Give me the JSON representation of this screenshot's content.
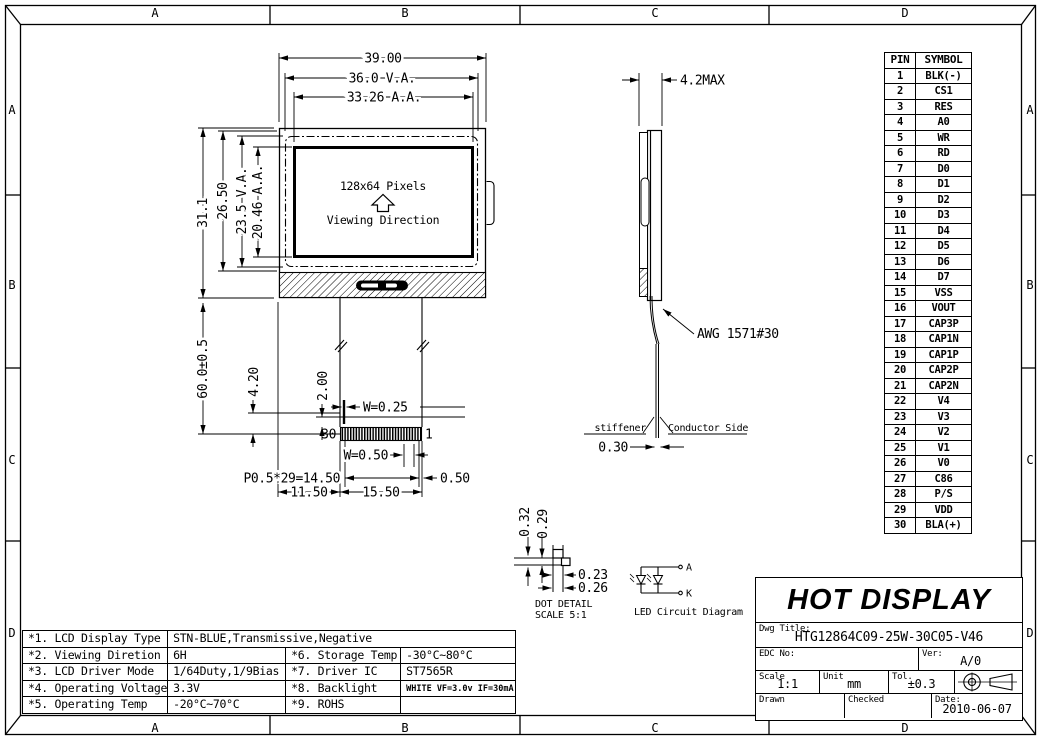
{
  "sheet": {
    "zone_columns": [
      "A",
      "B",
      "C",
      "D"
    ],
    "zone_rows": [
      "A",
      "B",
      "C",
      "D"
    ]
  },
  "front_view": {
    "screen_text": {
      "pixels": "128x64 Pixels",
      "viewing": "Viewing Direction"
    },
    "dims": {
      "width_total": "39.00",
      "width_va": "36.0 V.A.",
      "width_aa": "33.26 A.A.",
      "height_total": "31.1",
      "height_inner": "26.50",
      "height_va": "23.5 V.A.",
      "height_aa": "20.46 A.A.",
      "tail_length": "60.0±0.5",
      "tail_offset": "4.20",
      "tail_end": "2.00",
      "trace_width": "W=0.25",
      "pad_width": "W=0.50",
      "pitch": "P0.5*29=14.50",
      "edge_offset": "0.50",
      "left_offset": "11.50",
      "fpc_width": "15.50"
    },
    "pin_numbers": {
      "first": "30",
      "last": "1"
    }
  },
  "side_view": {
    "dims": {
      "thickness": "4.2MAX",
      "fpc_thickness": "0.30"
    },
    "labels": {
      "wire": "AWG 1571#30",
      "stiffener": "stiffener",
      "conductor_side": "Conductor Side"
    }
  },
  "dot_detail": {
    "dims": {
      "v_pitch": "0.32",
      "v_size": "0.29",
      "h_size": "0.23",
      "h_pitch": "0.26"
    },
    "title": "DOT DETAIL",
    "scale": "SCALE 5:1"
  },
  "led_diagram": {
    "anode": "A",
    "cathode": "K",
    "title": "LED Circuit Diagram"
  },
  "pin_table": {
    "headers": [
      "PIN",
      "SYMBOL"
    ],
    "rows": [
      [
        "1",
        "BLK(-)"
      ],
      [
        "2",
        "CS1"
      ],
      [
        "3",
        "RES"
      ],
      [
        "4",
        "A0"
      ],
      [
        "5",
        "WR"
      ],
      [
        "6",
        "RD"
      ],
      [
        "7",
        "D0"
      ],
      [
        "8",
        "D1"
      ],
      [
        "9",
        "D2"
      ],
      [
        "10",
        "D3"
      ],
      [
        "11",
        "D4"
      ],
      [
        "12",
        "D5"
      ],
      [
        "13",
        "D6"
      ],
      [
        "14",
        "D7"
      ],
      [
        "15",
        "VSS"
      ],
      [
        "16",
        "VOUT"
      ],
      [
        "17",
        "CAP3P"
      ],
      [
        "18",
        "CAP1N"
      ],
      [
        "19",
        "CAP1P"
      ],
      [
        "20",
        "CAP2P"
      ],
      [
        "21",
        "CAP2N"
      ],
      [
        "22",
        "V4"
      ],
      [
        "23",
        "V3"
      ],
      [
        "24",
        "V2"
      ],
      [
        "25",
        "V1"
      ],
      [
        "26",
        "V0"
      ],
      [
        "27",
        "C86"
      ],
      [
        "28",
        "P/S"
      ],
      [
        "29",
        "VDD"
      ],
      [
        "30",
        "BLA(+)"
      ]
    ]
  },
  "title_block": {
    "company": "HOT DISPLAY",
    "dwg_title_label": "Dwg Title:",
    "dwg_title": "HTG12864C09-25W-30C05-V46",
    "edc_label": "EDC No:",
    "edc_value": "",
    "ver_label": "Ver:",
    "ver_value": "A/0",
    "scale_label": "Scale",
    "scale_value": "1:1",
    "unit_label": "Unit",
    "unit_value": "mm",
    "tol_label": "Tol.",
    "tol_value": "±0.3",
    "drawn_label": "Drawn",
    "checked_label": "Checked",
    "date_label": "Date:",
    "date_value": "2010-06-07"
  },
  "spec_table": {
    "rows": [
      {
        "label": "*1. LCD Display Type",
        "value": "STN-BLUE,Transmissive,Negative",
        "span": true
      },
      {
        "label": "*2. Viewing Diretion",
        "value": "6H",
        "label2": "*6. Storage Temp",
        "value2": "-30°C~80°C"
      },
      {
        "label": "*3. LCD Driver Mode",
        "value": "1/64Duty,1/9Bias",
        "label2": "*7. Driver IC",
        "value2": "ST7565R"
      },
      {
        "label": "*4. Operating Voltage",
        "value": "3.3V",
        "label2": "*8. Backlight",
        "value2": "WHITE VF=3.0v IF=30mA",
        "small2": true
      },
      {
        "label": "*5. Operating Temp",
        "value": "-20°C~70°C",
        "label2": "*9. ROHS",
        "value2": ""
      }
    ]
  }
}
